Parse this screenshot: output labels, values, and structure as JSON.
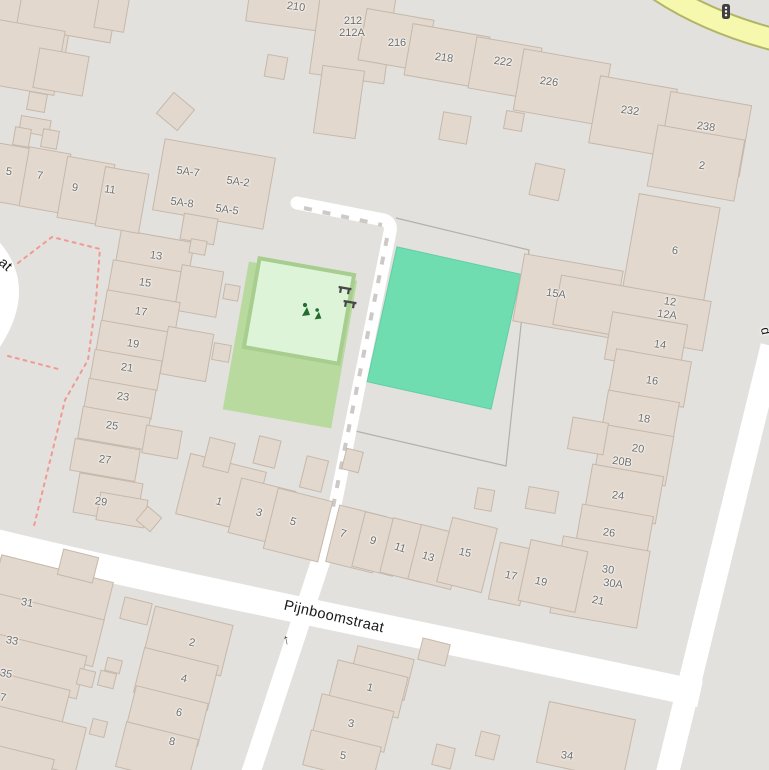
{
  "map": {
    "street_labels": [
      {
        "id": "pijnboomstraat",
        "text": "Pijnboomstraat",
        "x": 334,
        "y": 617,
        "rot": 13,
        "size": 14.5
      },
      {
        "id": "left-edge-partial",
        "text": "at",
        "x": 6,
        "y": 264,
        "rot": 42,
        "size": 14
      },
      {
        "id": "right-edge-partial",
        "text": "d",
        "x": 766,
        "y": 331,
        "rot": 78,
        "size": 13
      }
    ],
    "house_numbers": [
      {
        "t": "210",
        "x": 296,
        "y": 7,
        "r": 8
      },
      {
        "t": "212",
        "x": 353,
        "y": 21,
        "r": 0
      },
      {
        "t": "212A",
        "x": 352,
        "y": 33,
        "r": 0
      },
      {
        "t": "216",
        "x": 397,
        "y": 43,
        "r": 0
      },
      {
        "t": "218",
        "x": 444,
        "y": 58,
        "r": 8
      },
      {
        "t": "222",
        "x": 503,
        "y": 62,
        "r": 8
      },
      {
        "t": "226",
        "x": 549,
        "y": 82,
        "r": 8
      },
      {
        "t": "232",
        "x": 630,
        "y": 111,
        "r": 8
      },
      {
        "t": "238",
        "x": 706,
        "y": 127,
        "r": 8
      },
      {
        "t": "2",
        "x": 702,
        "y": 166,
        "r": 8
      },
      {
        "t": "6",
        "x": 675,
        "y": 251,
        "r": 8
      },
      {
        "t": "15A",
        "x": 556,
        "y": 294,
        "r": 8
      },
      {
        "t": "12",
        "x": 670,
        "y": 302,
        "r": 8
      },
      {
        "t": "12A",
        "x": 667,
        "y": 315,
        "r": 8
      },
      {
        "t": "14",
        "x": 660,
        "y": 345,
        "r": 8
      },
      {
        "t": "16",
        "x": 652,
        "y": 381,
        "r": 8
      },
      {
        "t": "18",
        "x": 644,
        "y": 419,
        "r": 8
      },
      {
        "t": "20",
        "x": 638,
        "y": 449,
        "r": 8
      },
      {
        "t": "20B",
        "x": 622,
        "y": 462,
        "r": 8
      },
      {
        "t": "24",
        "x": 618,
        "y": 496,
        "r": 8
      },
      {
        "t": "26",
        "x": 609,
        "y": 533,
        "r": 8
      },
      {
        "t": "30",
        "x": 608,
        "y": 570,
        "r": 8
      },
      {
        "t": "30A",
        "x": 613,
        "y": 584,
        "r": 8
      },
      {
        "t": "21",
        "x": 598,
        "y": 601,
        "r": 12
      },
      {
        "t": "17",
        "x": 511,
        "y": 576,
        "r": 12
      },
      {
        "t": "19",
        "x": 541,
        "y": 582,
        "r": 12
      },
      {
        "t": "15",
        "x": 465,
        "y": 553,
        "r": 12
      },
      {
        "t": "13",
        "x": 428,
        "y": 557,
        "r": 18
      },
      {
        "t": "11",
        "x": 400,
        "y": 548,
        "r": 18
      },
      {
        "t": "9",
        "x": 373,
        "y": 541,
        "r": 18
      },
      {
        "t": "7",
        "x": 343,
        "y": 534,
        "r": 18
      },
      {
        "t": "5",
        "x": 293,
        "y": 522,
        "r": 18
      },
      {
        "t": "3",
        "x": 259,
        "y": 513,
        "r": 16
      },
      {
        "t": "1",
        "x": 219,
        "y": 502,
        "r": 16
      },
      {
        "t": "5",
        "x": 9,
        "y": 172,
        "r": 8
      },
      {
        "t": "7",
        "x": 40,
        "y": 176,
        "r": 8
      },
      {
        "t": "9",
        "x": 75,
        "y": 188,
        "r": 8
      },
      {
        "t": "11",
        "x": 110,
        "y": 190,
        "r": 8
      },
      {
        "t": "5A-7",
        "x": 188,
        "y": 172,
        "r": 8
      },
      {
        "t": "5A-2",
        "x": 238,
        "y": 182,
        "r": 8
      },
      {
        "t": "5A-8",
        "x": 182,
        "y": 203,
        "r": 8
      },
      {
        "t": "5A-5",
        "x": 227,
        "y": 210,
        "r": 8
      },
      {
        "t": "13",
        "x": 156,
        "y": 256,
        "r": 8
      },
      {
        "t": "15",
        "x": 145,
        "y": 283,
        "r": 8
      },
      {
        "t": "17",
        "x": 141,
        "y": 312,
        "r": 8
      },
      {
        "t": "19",
        "x": 133,
        "y": 344,
        "r": 8
      },
      {
        "t": "21",
        "x": 127,
        "y": 368,
        "r": 8
      },
      {
        "t": "23",
        "x": 123,
        "y": 397,
        "r": 8
      },
      {
        "t": "25",
        "x": 112,
        "y": 426,
        "r": 8
      },
      {
        "t": "27",
        "x": 105,
        "y": 460,
        "r": 8
      },
      {
        "t": "29",
        "x": 101,
        "y": 502,
        "r": 8
      },
      {
        "t": "31",
        "x": 27,
        "y": 603,
        "r": 10
      },
      {
        "t": "33",
        "x": 12,
        "y": 641,
        "r": 10
      },
      {
        "t": "35",
        "x": 6,
        "y": 674,
        "r": 10
      },
      {
        "t": "7",
        "x": 3,
        "y": 698,
        "r": 10
      },
      {
        "t": "2",
        "x": 192,
        "y": 643,
        "r": 12
      },
      {
        "t": "4",
        "x": 184,
        "y": 679,
        "r": 12
      },
      {
        "t": "6",
        "x": 179,
        "y": 713,
        "r": 12
      },
      {
        "t": "8",
        "x": 172,
        "y": 742,
        "r": 12
      },
      {
        "t": "1",
        "x": 370,
        "y": 688,
        "r": 14
      },
      {
        "t": "3",
        "x": 351,
        "y": 724,
        "r": 10
      },
      {
        "t": "5",
        "x": 343,
        "y": 756,
        "r": 10
      },
      {
        "t": "34",
        "x": 567,
        "y": 756,
        "r": 8
      }
    ],
    "icons": [
      {
        "id": "traffic-signals",
        "x": 722,
        "y": 4
      },
      {
        "id": "oneway-arrow",
        "x": 287,
        "y": 644,
        "rot": -12,
        "glyph": "↑"
      },
      {
        "id": "bench",
        "x": 338,
        "y": 288,
        "rot": 10
      },
      {
        "id": "bench",
        "x": 343,
        "y": 302,
        "rot": 10
      },
      {
        "id": "playground-equipment",
        "x": 306,
        "y": 312,
        "s": 1
      },
      {
        "id": "playground-equipment",
        "x": 318,
        "y": 316,
        "s": 0.85
      }
    ],
    "colors": {
      "background": "#e2e1de",
      "building_fill": "#e2d8ce",
      "building_stroke": "#c6b8aa",
      "road_fill": "#ffffff",
      "yellow_road_fill": "#f6f8ae",
      "yellow_road_casing": "#b2b565",
      "pitch_fill": "#70ddb1",
      "pitch_stroke": "#5fcfa4",
      "grass_fill": "#b8da9e",
      "playground_fill": "#ddf4d8",
      "playground_band": "#a7ce8f",
      "dashed_boundary": "#f19a90",
      "parcel_line": "#b3b0ab",
      "path_dash": "#ccc9c6",
      "icon_dark": "#47464a",
      "icon_green": "#226d2d",
      "label_color": "#6f6e6b",
      "street_label_color": "#181818"
    }
  }
}
